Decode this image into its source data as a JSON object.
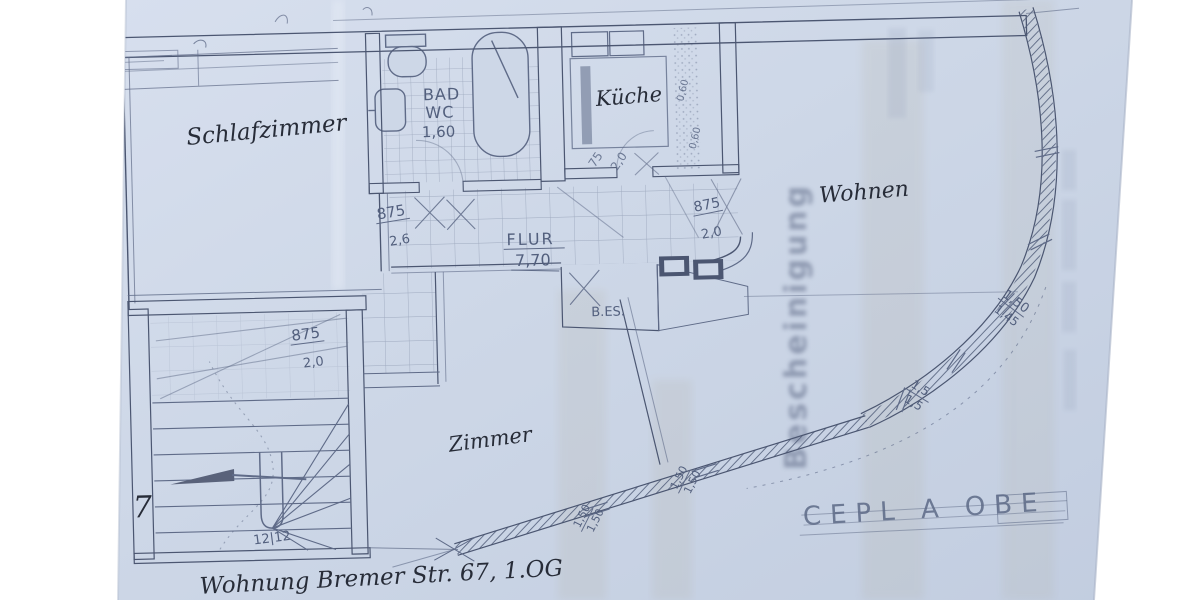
{
  "palette": {
    "paper": "#cdd7e7",
    "paper_light": "#dae2f0",
    "pencil": "#5f6b88",
    "wall": "#4b5671",
    "ink": "#272c38",
    "bleed": "#8d9ab5"
  },
  "rooms": {
    "schlafzimmer": {
      "label": "Schlafzimmer"
    },
    "bad": {
      "line1": "BAD",
      "line2": "WC",
      "size": "1,60"
    },
    "kueche": {
      "label": "Küche"
    },
    "wohnen": {
      "label": "Wohnen"
    },
    "flur": {
      "label": "FLUR",
      "size": "7,70"
    },
    "zimmer": {
      "label": "Zimmer"
    },
    "bes": {
      "label": "B.ES."
    }
  },
  "dims": {
    "flur_left": {
      "w": "875",
      "h": "2,6"
    },
    "flur_right": {
      "w": "875",
      "h": "2,0"
    },
    "stairs": {
      "w": "875",
      "h": "2,0"
    },
    "kitchen_door": {
      "w": "75",
      "h": "2,0"
    },
    "kitchen_side": {
      "a": "0,60",
      "b": "0,60"
    },
    "curve_upper": {
      "a": "1,50",
      "b": "1,45"
    },
    "curve_lower": {
      "a": "1,5",
      "b": "1,5"
    },
    "diag_upper": {
      "a": "1,50",
      "b": "1,50"
    },
    "diag_lower": {
      "a": "1,50",
      "b": "1,50"
    },
    "stair_steps": "12|12",
    "margin_note": "7"
  },
  "annotations": {
    "address": "Wohnung Bremer Str. 67, 1.OG",
    "pencil_caps": "CEPL A OBE",
    "bleedthrough": "Bescheinigung"
  }
}
